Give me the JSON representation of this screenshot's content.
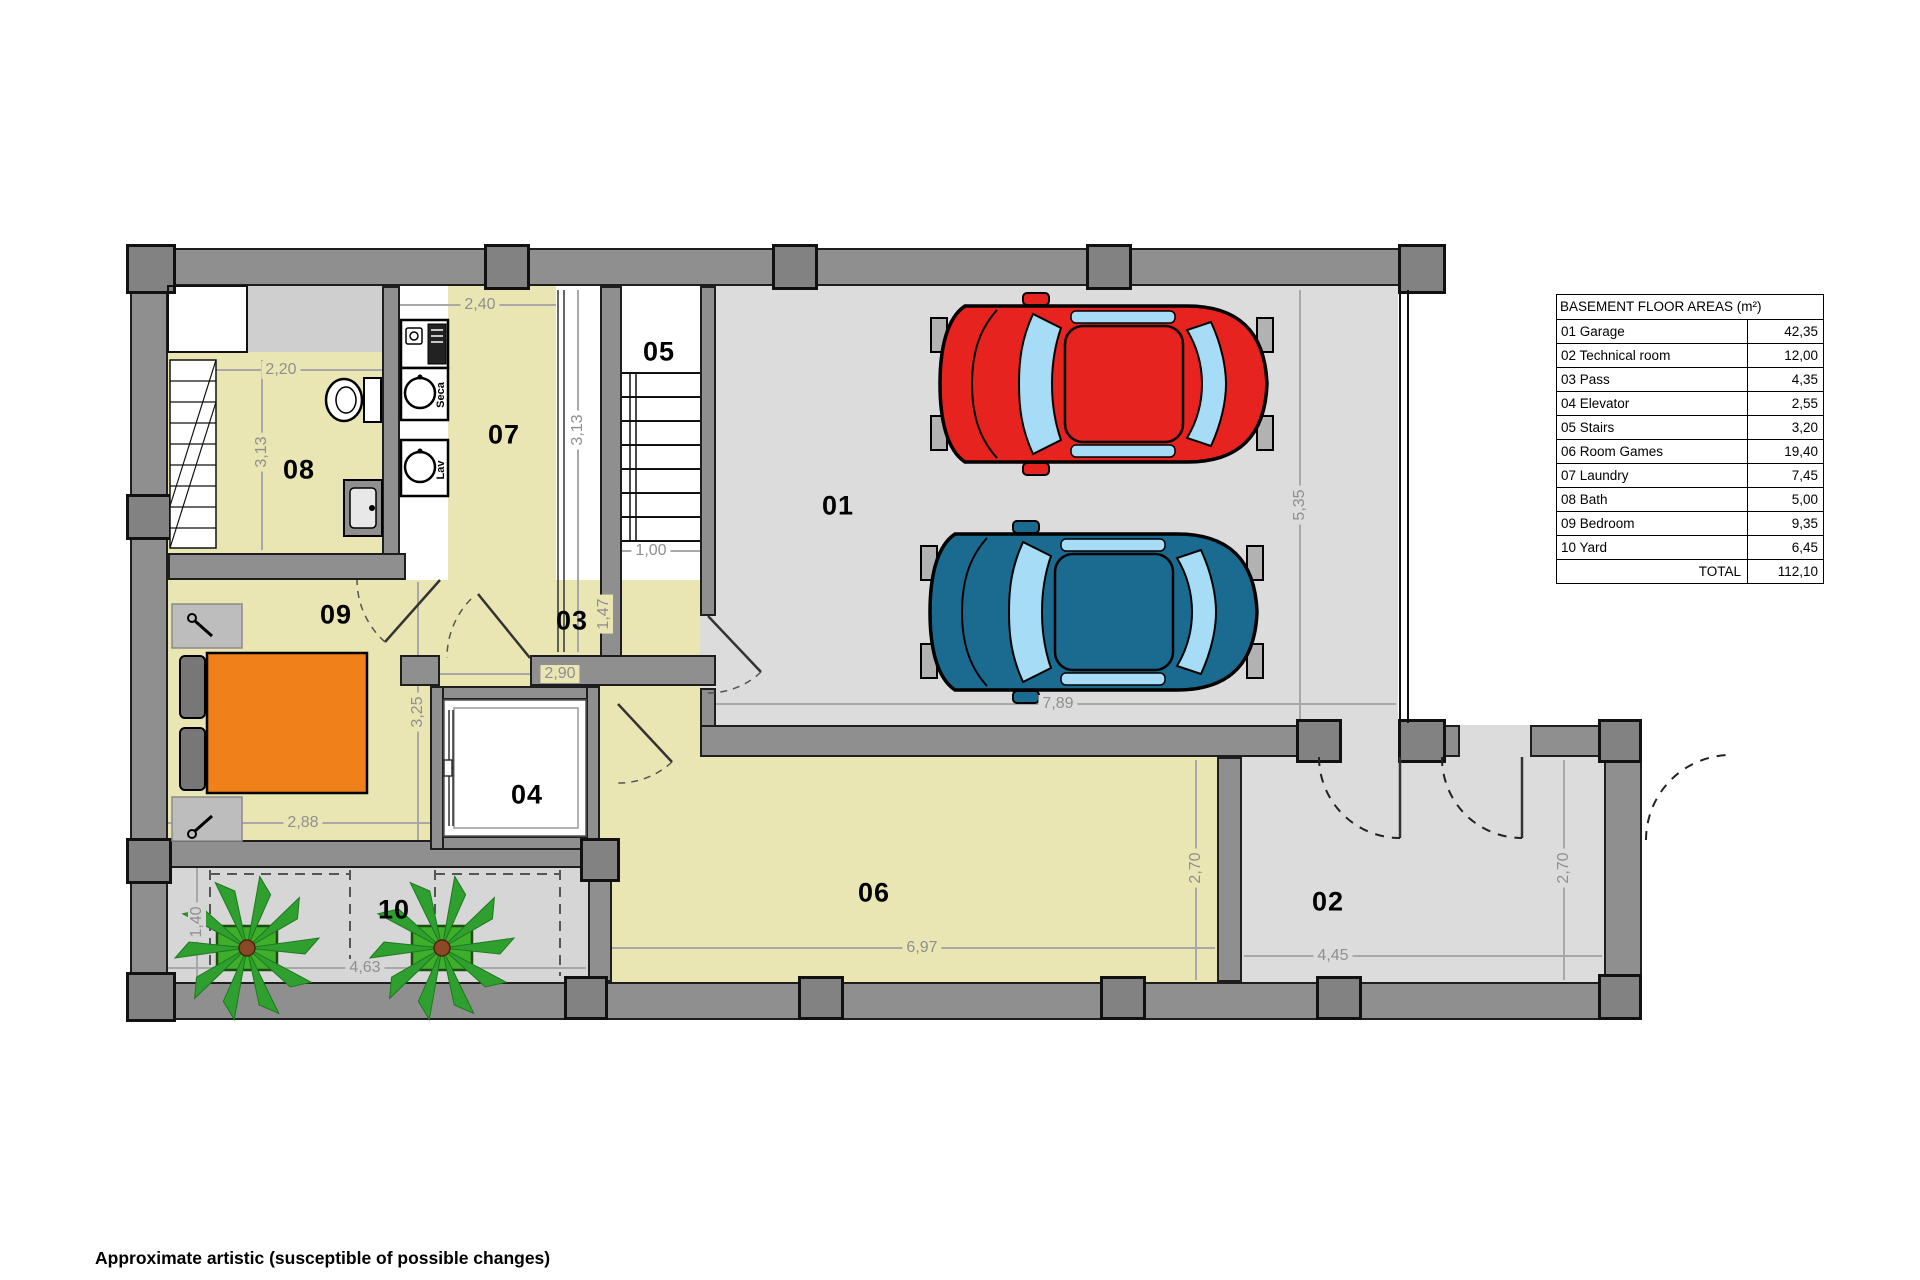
{
  "table": {
    "title": "BASEMENT FLOOR AREAS (m²)",
    "rows": [
      {
        "num": "01",
        "name": "01  Garage",
        "area": "42,35"
      },
      {
        "num": "02",
        "name": "02  Technical room",
        "area": "12,00"
      },
      {
        "num": "03",
        "name": "03 Pass",
        "area": "4,35"
      },
      {
        "num": "04",
        "name": "04  Elevator",
        "area": "2,55"
      },
      {
        "num": "05",
        "name": "05  Stairs",
        "area": "3,20"
      },
      {
        "num": "06",
        "name": "06  Room Games",
        "area": "19,40"
      },
      {
        "num": "07",
        "name": "07  Laundry",
        "area": "7,45"
      },
      {
        "num": "08",
        "name": "08  Bath",
        "area": "5,00"
      },
      {
        "num": "09",
        "name": "09 Bedroom",
        "area": "9,35"
      },
      {
        "num": "10",
        "name": "10  Yard",
        "area": "6,45"
      }
    ],
    "total_label": "TOTAL",
    "total_value": "112,10"
  },
  "rooms": {
    "garage": "01",
    "technical": "02",
    "pass": "03",
    "elevator": "04",
    "stairs": "05",
    "games": "06",
    "laundry": "07",
    "bath": "08",
    "bedroom": "09",
    "yard": "10"
  },
  "dims": {
    "laundry_top": "2,40",
    "bath_top": "2,20",
    "bath_left": "3,13",
    "laundry_right": "3,13",
    "stairs_exit": "1,00",
    "garage_height": "5,35",
    "garage_width": "7,89",
    "pass_height": "1,47",
    "pass_width": "2,90",
    "bedroom_height": "3,25",
    "bedroom_width": "2,88",
    "yard_height": "1,40",
    "yard_width": "4,63",
    "games_width": "6,97",
    "games_height": "2,70",
    "technical_height": "2,70",
    "technical_width": "4,45"
  },
  "fixtures": {
    "dryer_label": "Seca",
    "washer_label": "Lav"
  },
  "caption": "Approximate artistic (susceptible of possible changes)",
  "colors": {
    "floor_yellow": "#eae6b4",
    "floor_gray": "#dcdcdc",
    "wall_gray": "#8f8f8f",
    "pillar_gray": "#828282",
    "car_red": "#e6231e",
    "car_blue": "#1a6b8f",
    "car_glass": "#a6dcf5",
    "bed_orange": "#f08019",
    "plant_green": "#2fa02f",
    "dim_text": "#8f8f8f"
  }
}
